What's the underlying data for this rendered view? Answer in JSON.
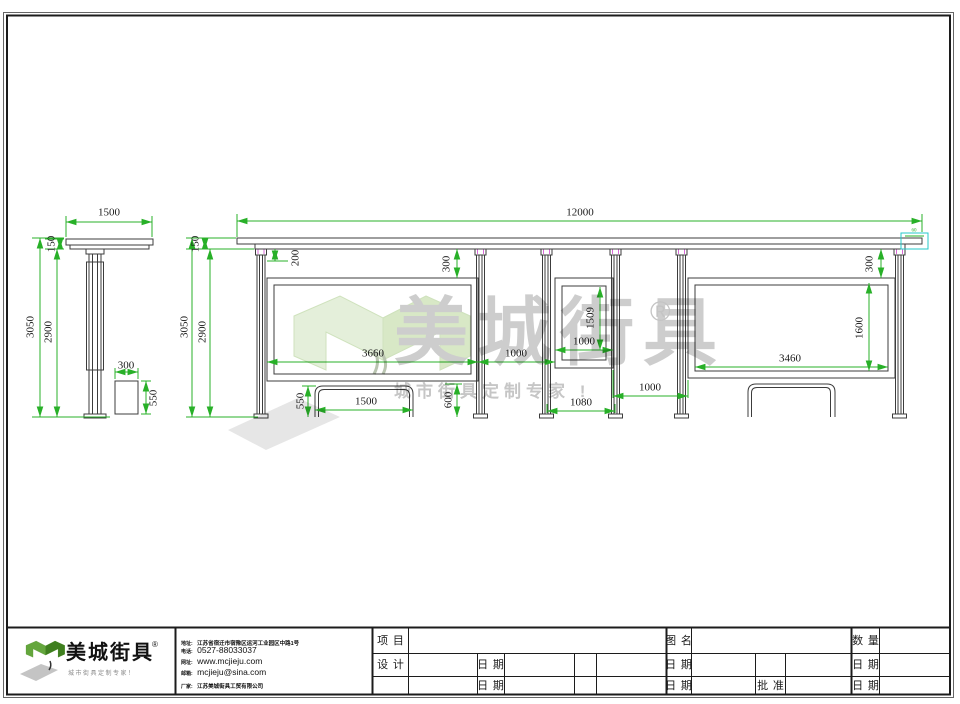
{
  "watermark": {
    "brand": "美城街具",
    "registered": "®",
    "tagline": "城市街具定制专家 !"
  },
  "logo": {
    "brand": "美城街具",
    "registered": "®",
    "tagline": "城市街具定制专家！"
  },
  "company": {
    "address_label": "地址:",
    "address": "江苏省宿迁市宿豫区运河工业园区中路1号",
    "phone_label": "电话:",
    "phone": "0527-88033037",
    "web_label": "网址:",
    "web": "www.mcjieju.com",
    "email_label": "邮箱:",
    "email": "mcjieju@sina.com",
    "factory_label": "厂家:",
    "factory": "江苏美城街具工贸有限公司"
  },
  "title_block": {
    "project": "项 目",
    "design": "设 计",
    "drawing_name": "图 名",
    "quantity": "数 量",
    "date": "日 期",
    "approve": "批 准"
  },
  "colors": {
    "dimension_green": "#28b028",
    "callout_cyan": "#25c9c9",
    "logo_green": "#64a63d"
  },
  "side_view": {
    "dims": {
      "roof_width": "1500",
      "roof_height": "150",
      "total_height": "3050",
      "column_height": "2900",
      "bin_width": "300",
      "bin_height": "550"
    }
  },
  "front_view": {
    "dims": {
      "total_width": "12000",
      "roof_height": "150",
      "total_height": "3050",
      "column_height": "2900",
      "roof_gap": "200",
      "panel_top_gap_left": "300",
      "left_panel_width": "3660",
      "left_gap": "1000",
      "kiosk_height": "1509",
      "kiosk_width": "1000",
      "right_gap": "1000",
      "kiosk_columns_span": "1080",
      "panel_top_gap_right": "300",
      "right_panel_height": "1600",
      "right_panel_width": "3460",
      "bench_height": "550",
      "bench_width": "1500",
      "bench_back_height": "600",
      "roof_edge": "60"
    }
  }
}
